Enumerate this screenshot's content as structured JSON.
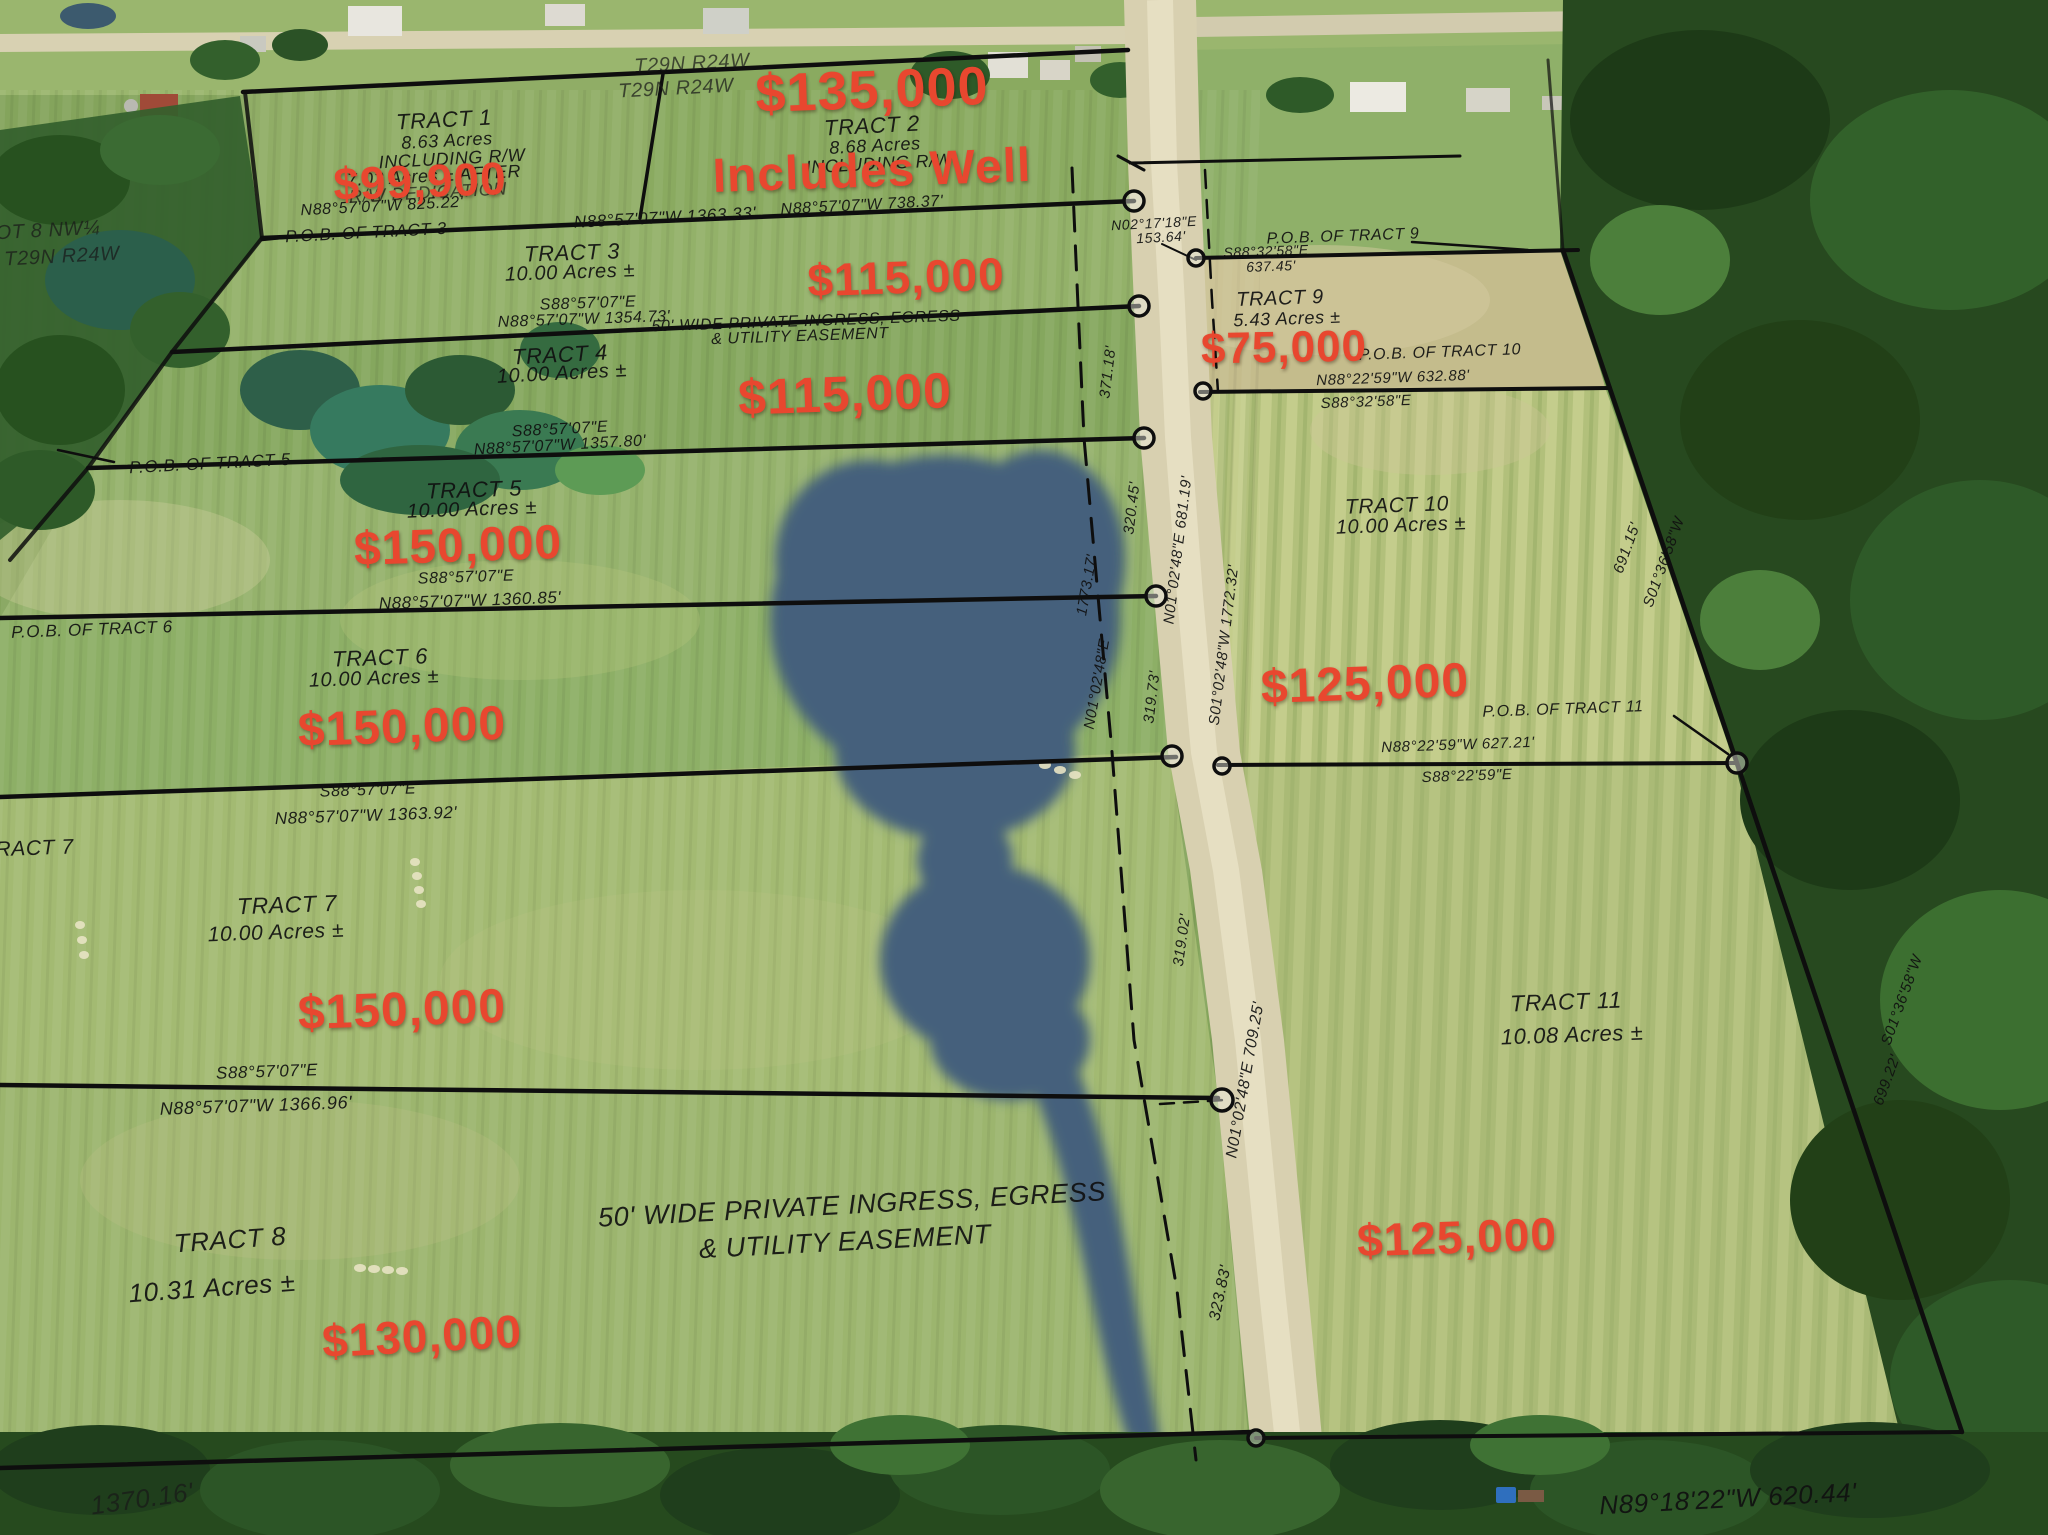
{
  "township": {
    "row1": "T29N  R24W",
    "row2": "T29N  R24W",
    "corner_row1": "OT 8 NW¼",
    "corner_row2": "T29N  R24W"
  },
  "tracts": {
    "t1": {
      "title": "TRACT 1",
      "line2": "8.63 Acres",
      "line3": "INCLUDING R/W",
      "line4": "7.02 Acres ± AFTER",
      "line5": "R/W DEDICATION",
      "price": "$99,900"
    },
    "t2": {
      "title": "TRACT 2",
      "line2": "8.68 Acres",
      "line3": "INCLUDING R/W",
      "price": "$135,000",
      "note": "Includes Well"
    },
    "t3": {
      "title": "TRACT 3",
      "line2": "10.00 Acres ±",
      "price": "$115,000",
      "pob": "P.O.B. OF TRACT 3"
    },
    "t4": {
      "title": "TRACT 4",
      "line2": "10.00 Acres ±",
      "price": "$115,000"
    },
    "t5": {
      "title": "TRACT 5",
      "line2": "10.00 Acres ±",
      "price": "$150,000",
      "pob": "P.O.B. OF TRACT 5"
    },
    "t6": {
      "title": "TRACT 6",
      "line2": "10.00 Acres ±",
      "price": "$150,000",
      "pob": "P.O.B. OF TRACT 6"
    },
    "t7": {
      "title": "TRACT 7",
      "line2": "10.00 Acres ±",
      "price": "$150,000",
      "edge_label": "TRACT 7"
    },
    "t8": {
      "title": "TRACT 8",
      "line2": "10.31 Acres ±",
      "price": "$130,000"
    },
    "t9": {
      "title": "TRACT 9",
      "line2": "5.43 Acres ±",
      "price": "$75,000",
      "pob": "P.O.B. OF TRACT 9"
    },
    "t10": {
      "title": "TRACT 10",
      "line2": "10.00 Acres ±",
      "price": "$125,000",
      "pob": "P.O.B. OF TRACT 10"
    },
    "t11": {
      "title": "TRACT 11",
      "line2": "10.08 Acres ±",
      "price": "$125,000",
      "pob": "P.O.B. OF TRACT 11"
    }
  },
  "easement_upper": {
    "line1": "50' WIDE PRIVATE INGRESS, EGRESS",
    "line2": "& UTILITY EASEMENT"
  },
  "easement_lower": {
    "line1": "50' WIDE PRIVATE INGRESS, EGRESS",
    "line2": "& UTILITY EASEMENT"
  },
  "bearings": {
    "s8857": "S88°57'07\"E",
    "w1": "N88°57'07\"W  825.22'",
    "w2": "N88°57'07\"W  1363.33'",
    "w3": "N88°57'07\"W  738.37'",
    "w4": "N88°57'07\"W  1354.73'",
    "w5": "N88°57'07\"W  1357.80'",
    "w6": "N88°57'07\"W  1360.85'",
    "w7": "N88°57'07\"W  1363.92'",
    "w8": "N88°57'07\"W  1366.96'",
    "w9": "1370.16'",
    "r1": "371.18'",
    "r2": "320.45'",
    "r3": "1773.17'",
    "r4": "N01°02'48\"E  681.19'",
    "r5": "S01°02'48\"W  1772.32'",
    "r6": "N01°02'48\"E",
    "r7": "319.73'",
    "r8": "319.02'",
    "r9": "N01°02'48\"E  709.25'",
    "r10": "323.83'",
    "e1a": "N02°17'18\"E",
    "e1b": "153.64'",
    "e2": "S88°32'58\"E",
    "e3": "637.45'",
    "e4": "N88°22'59\"W  632.88'",
    "e5": "S88°32'58\"E",
    "e6": "691.15'",
    "e7": "S01°36'58\"W",
    "e8": "N88°22'59\"W  627.21'",
    "e9": "S88°22'59\"E",
    "e10": "699.22'",
    "e11": "S01°36'58\"W",
    "e12": "N89°18'22\"W  620.44'"
  },
  "colors": {
    "price_red": "#e8472f",
    "survey_ink": "#141414",
    "pond": "#44607b",
    "road": "#d8d0b2",
    "field_green": "#87a95f",
    "tree_green": "#2b5226"
  }
}
